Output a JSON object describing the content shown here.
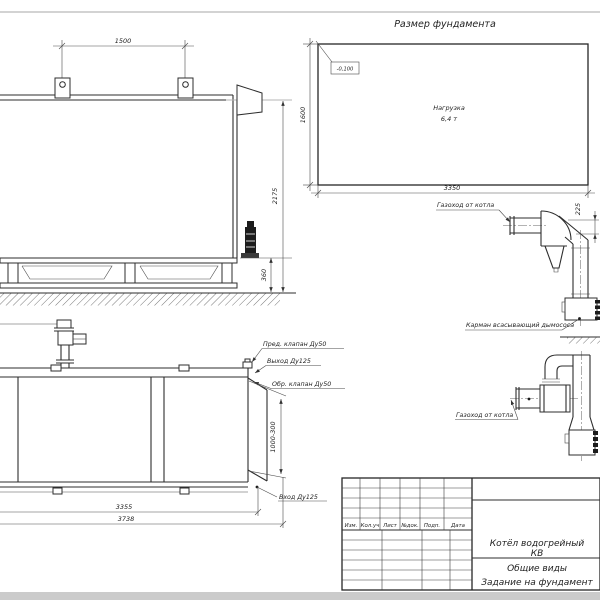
{
  "drawing": {
    "title": "Размер фундамента",
    "foundation": {
      "elevation": "-0,100",
      "load_line1": "Нагрузка",
      "load_line2": "6,4 т",
      "dim_width": "3350",
      "dim_height": "1600"
    },
    "side_view": {
      "dim_lug_spacing": "1500",
      "dim_height": "2175",
      "dim_base_height": "360"
    },
    "plan_view": {
      "dim_length_inner": "3355",
      "dim_length_total": "3738",
      "dim_right_side": "1000-300",
      "label_safety_valve": "Пред. клапан Ду50",
      "label_outlet": "Выход Ду125",
      "label_check_valve": "Обр. клапан Ду50",
      "label_inlet": "Вход Ду125"
    },
    "flue_upper": {
      "label_duct": "Газоход от котла",
      "dim_offset": "225",
      "label_pocket": "Карман всасывающий дымососа"
    },
    "flue_lower": {
      "label_duct": "Газоход от котла"
    },
    "title_block": {
      "columns": [
        "Изм.",
        "Кол.уч",
        "Лист",
        "№док.",
        "Подп.",
        "Дата"
      ],
      "product_line1": "Котёл водогрейный",
      "product_line2": "КВ",
      "doc_line1": "Общие виды",
      "doc_line2": "Задание на фундамент"
    }
  },
  "colors": {
    "line": "#2d2d2d",
    "thin_line": "#4a4a4a",
    "centerline": "#b5b5b5",
    "sheet_edge": "#cccccc",
    "background": "#ffffff"
  }
}
